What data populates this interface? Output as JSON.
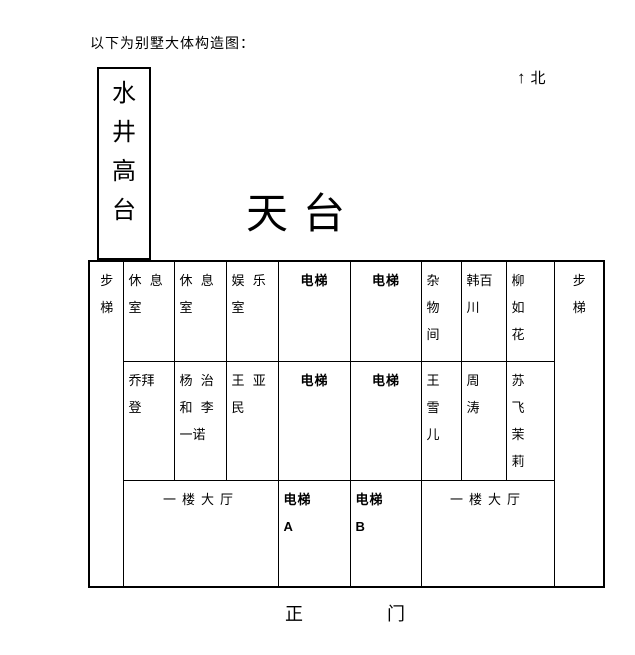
{
  "colors": {
    "ink": "#000000",
    "background": "#ffffff"
  },
  "header": {
    "caption": "以下为别墅大体构造图：",
    "north": {
      "arrow": "↑",
      "label": "北"
    }
  },
  "diagram": {
    "well_platform": "水\n井\n高\n台",
    "rooftop": "天台",
    "stairs_left": "步\n梯",
    "stairs_right": "步\n梯",
    "main_gate": {
      "left": "正",
      "right": "门"
    },
    "floor_table": {
      "row1": {
        "rest_room_1": "休 息\n室",
        "rest_room_2": "休 息\n室",
        "entertainment_room": "娱 乐\n室",
        "elevator_left": "电梯",
        "elevator_right": "电梯",
        "storage_room": "杂\n物\n间",
        "han_baichuan": "韩百\n川",
        "liu_ruhua": "柳\n如\n花"
      },
      "row2": {
        "qiao_baideng": "乔拜\n登",
        "yang_zhihe_li_yinuo": "杨 治\n和 李\n一诺",
        "wang_yamin": "王 亚\n民",
        "elevator_left": "电梯",
        "elevator_right": "电梯",
        "wang_xueer": "王\n雪\n儿",
        "zhou_tao": "周\n涛",
        "su_fei_moli": "苏\n飞\n茉\n莉"
      },
      "row3": {
        "hall_left": "一楼大厅",
        "elevator_a": "电梯\nA",
        "elevator_b": "电梯\nB",
        "hall_right": "一楼大厅"
      }
    }
  }
}
